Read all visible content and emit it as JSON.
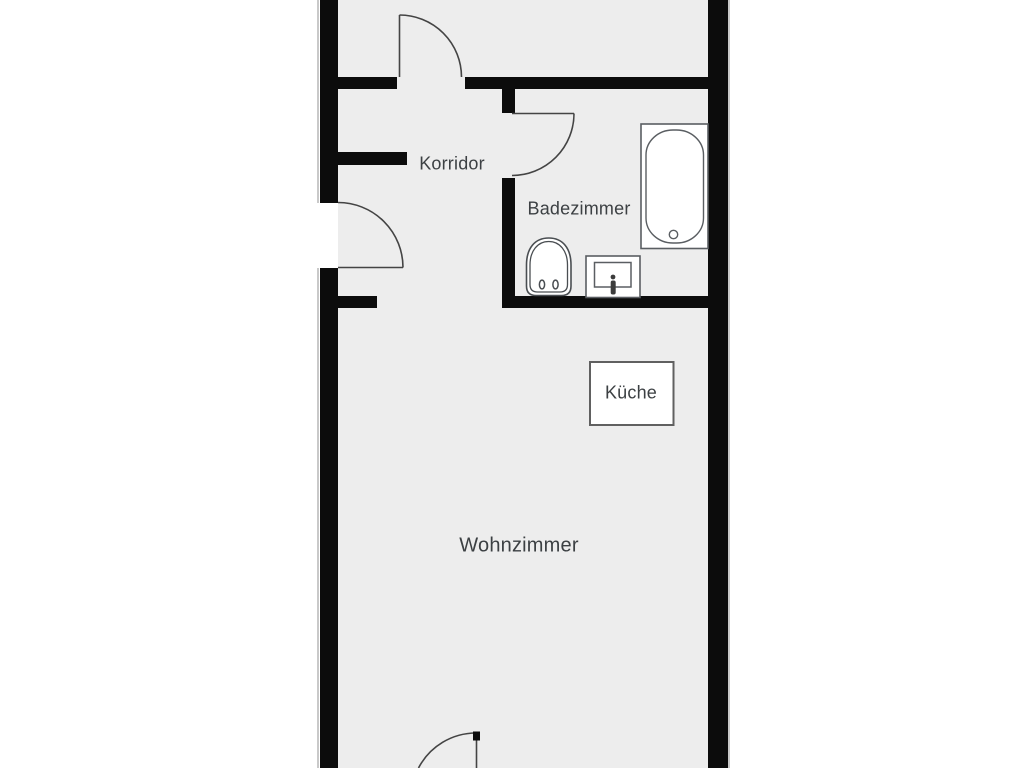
{
  "plan": {
    "type": "floor-plan",
    "language": "de",
    "rooms": [
      {
        "id": "korridor",
        "label": "Korridor"
      },
      {
        "id": "badezimmer",
        "label": "Badezimmer"
      },
      {
        "id": "kueche",
        "label": "Küche"
      },
      {
        "id": "wohnzimmer",
        "label": "Wohnzimmer"
      }
    ],
    "fixtures": [
      {
        "id": "bathtub",
        "name": "bathtub-icon"
      },
      {
        "id": "toilet",
        "name": "toilet-icon"
      },
      {
        "id": "washbasin",
        "name": "washbasin-icon"
      },
      {
        "id": "kitchen",
        "name": "kitchen-marker-box"
      }
    ],
    "door_count": 4,
    "colors": {
      "background": "#ffffff",
      "floor": "#ededed",
      "wall": "#0c0c0c",
      "fixture_outline": "#5a5e62",
      "door_line": "#444444",
      "label_text": "#3c4043"
    }
  }
}
